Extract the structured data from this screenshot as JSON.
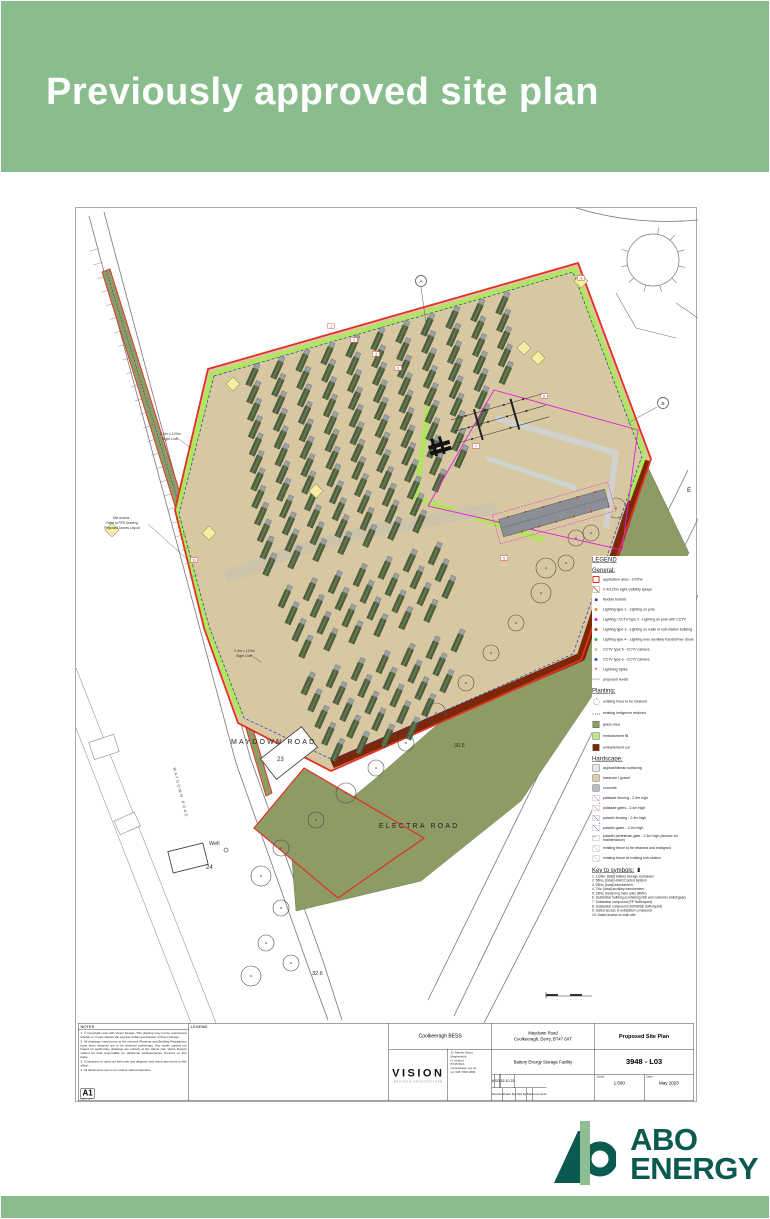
{
  "header": {
    "title": "Previously approved site plan"
  },
  "colors": {
    "header_green": "#89bd8e",
    "brand_teal": "#0b5a50",
    "boundary_red": "#e33022",
    "gravel_tan": "#d8c8a2",
    "grass_olive": "#8d9c64",
    "embankment_lime": "#b9ec86",
    "embankment_cut": "#7c2808",
    "palisade_magenta": "#e020e0",
    "paladin_blue": "#2233cc"
  },
  "plan": {
    "labels": {
      "maydown_road": "MAYDOWN ROAD",
      "electra_road": "ELECTRA ROAD",
      "electra_e": "E",
      "level_1": "30.5",
      "level_2": "32.6",
      "building_23": "23",
      "building_24": "24",
      "well": "Well"
    },
    "sight_line": {
      "l1": "2.4m x 120m",
      "l2": "Sight Line"
    },
    "site_access": [
      "Site Access -",
      "Refer to RPS Drawing",
      "'Proposed Access Layout'"
    ],
    "callouts": [
      "A",
      "B"
    ],
    "badges": [
      "1",
      "2",
      "3",
      "4",
      "5",
      "6",
      "7",
      "8",
      "9",
      "10"
    ]
  },
  "legend": {
    "title": "LEGEND",
    "general": {
      "heading": "General:",
      "items": [
        {
          "swatch": "app-area",
          "label": "application area - 3.47ha"
        },
        {
          "swatch": "splay",
          "label": "2.4x120m sight visibility splays"
        },
        {
          "swatch": "dot-blue-sq",
          "label": "flexible bollard"
        },
        {
          "swatch": "dot-orange",
          "label": "Lighting type 1 - Lighting on pole"
        },
        {
          "swatch": "dot-magenta",
          "label": "Lighting / CCTV type 2 - Lighting on pole with CCTV"
        },
        {
          "swatch": "dot-red",
          "label": "Lighting type 3 - Lighting on walls of sub-station building"
        },
        {
          "swatch": "dot-green",
          "label": "Lighting type 4 - Lighting over auxiliary transformer doors"
        },
        {
          "swatch": "dot-yellow",
          "label": "CCTV type 5 - CCTV camera"
        },
        {
          "swatch": "dot-blue",
          "label": "CCTV type 6 - CCTV camera"
        },
        {
          "swatch": "spike",
          "label": "Lightning Spike",
          "glyph": "✶"
        },
        {
          "swatch": "levels",
          "label": "proposed levels",
          "glyph": "(x.xx)"
        }
      ]
    },
    "planting": {
      "heading": "Planting:",
      "items": [
        {
          "swatch": "tree",
          "label": "existing trees to be retained"
        },
        {
          "swatch": "hedge",
          "label": "existing hedgerow retained"
        },
        {
          "swatch": "fill-grass",
          "label": "grass area"
        },
        {
          "swatch": "fill-lime",
          "label": "embankment fill"
        },
        {
          "swatch": "fill-cut",
          "label": "embankment cut"
        }
      ]
    },
    "hardscape": {
      "heading": "Hardscape:",
      "items": [
        {
          "swatch": "fill-asphalt",
          "label": "asphalt/bitmac surfacing"
        },
        {
          "swatch": "fill-gravel",
          "label": "hardcore / gravel"
        },
        {
          "swatch": "fill-concrete",
          "label": "concrete"
        },
        {
          "swatch": "line-magenta",
          "label": "palisade fencing - 2.4m high"
        },
        {
          "swatch": "gate-magenta",
          "label": "palisade gates - 2.4m high"
        },
        {
          "swatch": "line-blue",
          "label": "paladin fencing - 2.4m high"
        },
        {
          "swatch": "gate-blue",
          "label": "paladin gates - 2.4m high"
        },
        {
          "swatch": "ped-blue",
          "label": "paladin pedestrian gate - 2.4m high (access for maintenance)"
        },
        {
          "swatch": "line-cyan",
          "label": "existing fence to be retained and realigned"
        },
        {
          "swatch": "line-gray",
          "label": "existing fence at existing sub-station"
        }
      ]
    },
    "key": {
      "heading": "Key to symbols:",
      "marker": "▮",
      "items": [
        "1.  112No. [total] battery storage containers",
        "2.  56No. [total] HVAC/Control System",
        "3.  28No. [total] transformers",
        "4.  7No. [total] auxiliary transformers",
        "5.  18No. [total] ring main units (RMU)",
        "6.  Substation building (containing NIE and customer switchgear)",
        "7.  Substation compound (PP Switchyard)",
        "8.  Substation compound (SONI/NIE Switchyard)",
        "9.  Gated access to substation compound",
        "10. Gated access to main site"
      ]
    }
  },
  "notes": {
    "heading": "NOTES",
    "items": [
      "1. © Copyright rests with Vision Design. This drawing may not be reproduced wholely or in part without the express written permission of Vision Design.",
      "2. All drawings issued prior to the relevant Planning and Building Regulations have been obtained are to be deemed preliminary. Any works carried out based on preliminary drawings are entirely at the clients risk. Vision Design cannot be held responsible for additional works/expense incurred on this basis.",
      "3. Contractors to carry out their own due diligence and report any errors to this office.",
      "4. All dimensions are in mm unless stated otherwise."
    ],
    "paper_size": "A1",
    "paper_size_caption": "paper size"
  },
  "legend_box": {
    "heading": "LEGEND"
  },
  "titleblock": {
    "project": "Coolkeeragh BESS",
    "firm": {
      "name": "VISION",
      "tagline": "DESIGN & ARCHITECTURE",
      "address": [
        "31 Rainey Street",
        "Magherafelt",
        "N. Ireland",
        "BT45 5DA",
        "visiondesign.org.uk",
        "tel: 028 7930 0866"
      ]
    },
    "site_address_1": "Maydown Road",
    "site_address_2": "Coolkeeragh, Derry, BT47 6XT",
    "facility": "Battery Energy Storage Facility",
    "drawing_title": "Proposed Site Plan",
    "drawing_number": "3948 - L03",
    "revision": {
      "values": [
        "A",
        "SO",
        "",
        "02.10.23",
        ""
      ],
      "labels": [
        "Revision",
        "Drawn By",
        "Chkd By",
        "Date",
        "Comments"
      ]
    },
    "scale_label": "Scale",
    "scale": "1:500",
    "date_label": "Date",
    "date": "May 2023"
  },
  "footer": {
    "brand_line1": "ABO",
    "brand_line2": "ENERGY"
  }
}
